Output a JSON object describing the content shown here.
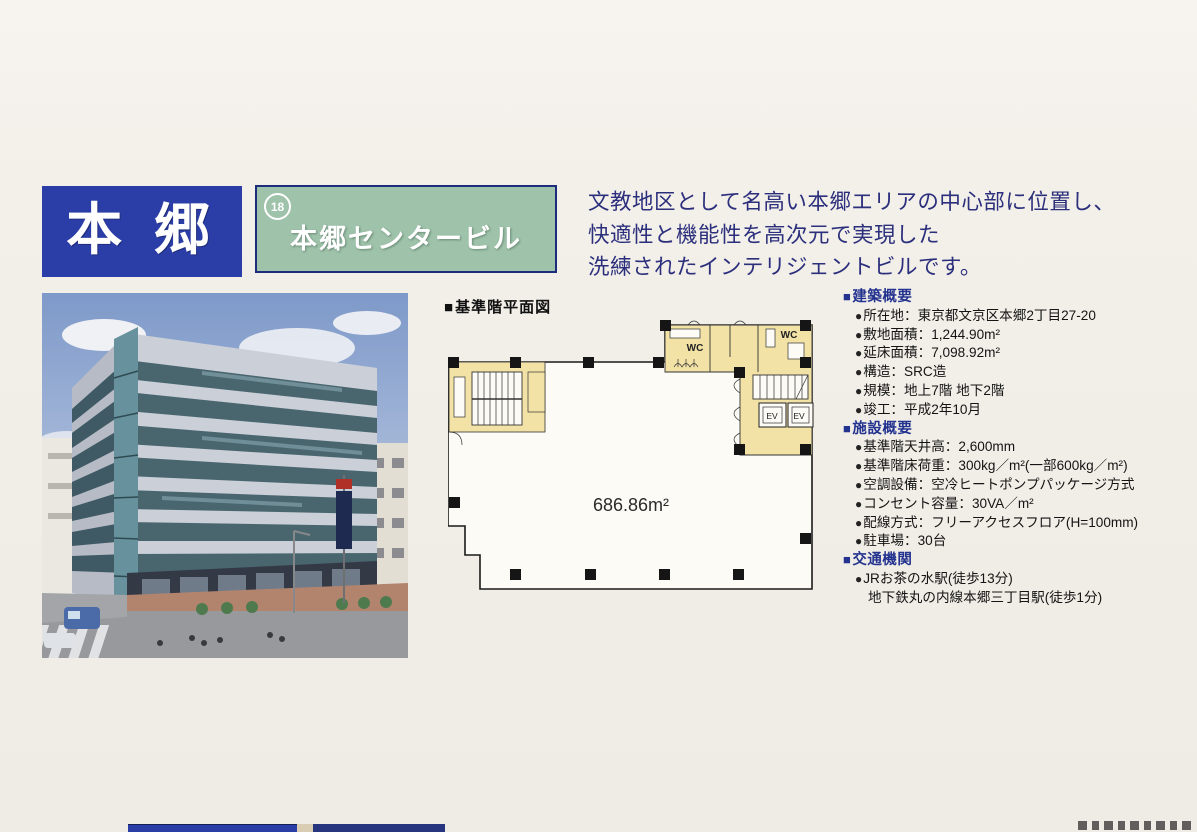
{
  "ui": {
    "section_marker": "■",
    "bullet": "●"
  },
  "header": {
    "district_label": "本 郷",
    "badge_number": "18",
    "building_name": "本郷センタービル",
    "description_lines": [
      "文教地区として名高い本郷エリアの中心部に位置し、",
      "快適性と機能性を高次元で実現した",
      "洗練されたインテリジェントビルです。"
    ]
  },
  "floor_plan": {
    "title": "基準階平面図",
    "area": "686.86m²",
    "wc": "WC",
    "ev": "EV"
  },
  "sections": [
    {
      "heading": "建築概要",
      "items": [
        "所在地：東京都文京区本郷2丁目27-20",
        "敷地面積：1,244.90m²",
        "延床面積：7,098.92m²",
        "構造：SRC造",
        "規模：地上7階 地下2階",
        "竣工：平成2年10月"
      ]
    },
    {
      "heading": "施設概要",
      "items": [
        "基準階天井高：2,600mm",
        "基準階床荷重：300kg／m²(一部600kg／m²)",
        "空調設備：空冷ヒートポンプパッケージ方式",
        "コンセント容量：30VA／m²",
        "配線方式：フリーアクセスフロア(H=100mm)",
        "駐車場：30台"
      ]
    },
    {
      "heading": "交通機関",
      "items": [
        "JRお茶の水駅(徒歩13分)",
        "地下鉄丸の内線本郷三丁目駅(徒歩1分)"
      ]
    }
  ],
  "colors": {
    "primary_blue": "#2b3da6",
    "box_green": "#9fc2ab",
    "border_navy": "#1c2c7c",
    "description_navy": "#2c2f7c",
    "heading_blue": "#23338f",
    "plan_core_yellow": "#f2e2a6",
    "page_background": "#f1eee8"
  }
}
